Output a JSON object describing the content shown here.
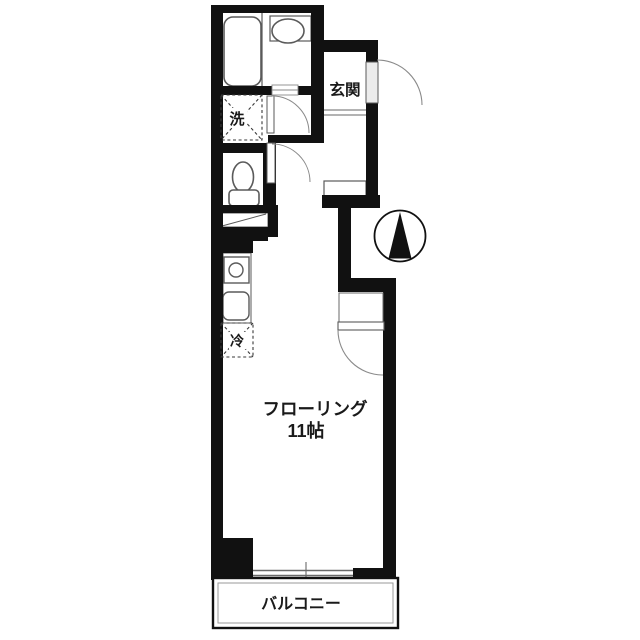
{
  "drawing": {
    "type": "apartment-floor-plan",
    "colors": {
      "wall": "#111111",
      "fixture_line": "#5a5a5a",
      "door_arc": "#8a8a8a",
      "background": "#ffffff"
    },
    "labels": {
      "genkan": "玄関",
      "laundry": "洗",
      "fridge": "冷",
      "flooring_line1": "フローリング",
      "flooring_line2": "11帖",
      "balcony": "バルコニー"
    },
    "symbols": {
      "north_arrow": "compass-circle-with-black-triangle"
    }
  }
}
